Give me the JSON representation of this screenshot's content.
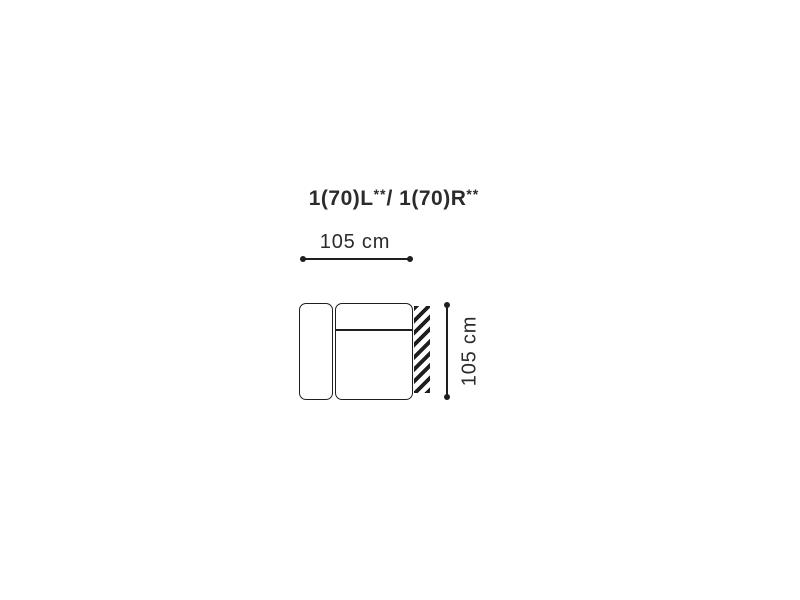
{
  "diagram": {
    "title": {
      "part1": "1(70)L",
      "sup1": "**",
      "part2": "/ 1(70)R",
      "sup2": "**"
    },
    "width_dimension": {
      "label": "105 cm"
    },
    "height_dimension": {
      "label": "105 cm"
    },
    "shapes": {
      "armrest": "sofa-armrest-outline",
      "seat": "sofa-seat-outline",
      "divider": "backrest-divider-line",
      "hatch": "wall-side-hatch-stripes"
    }
  },
  "colors": {
    "background": "#ffffff",
    "line": "#1f1f1f",
    "text": "#2b2b2b"
  }
}
